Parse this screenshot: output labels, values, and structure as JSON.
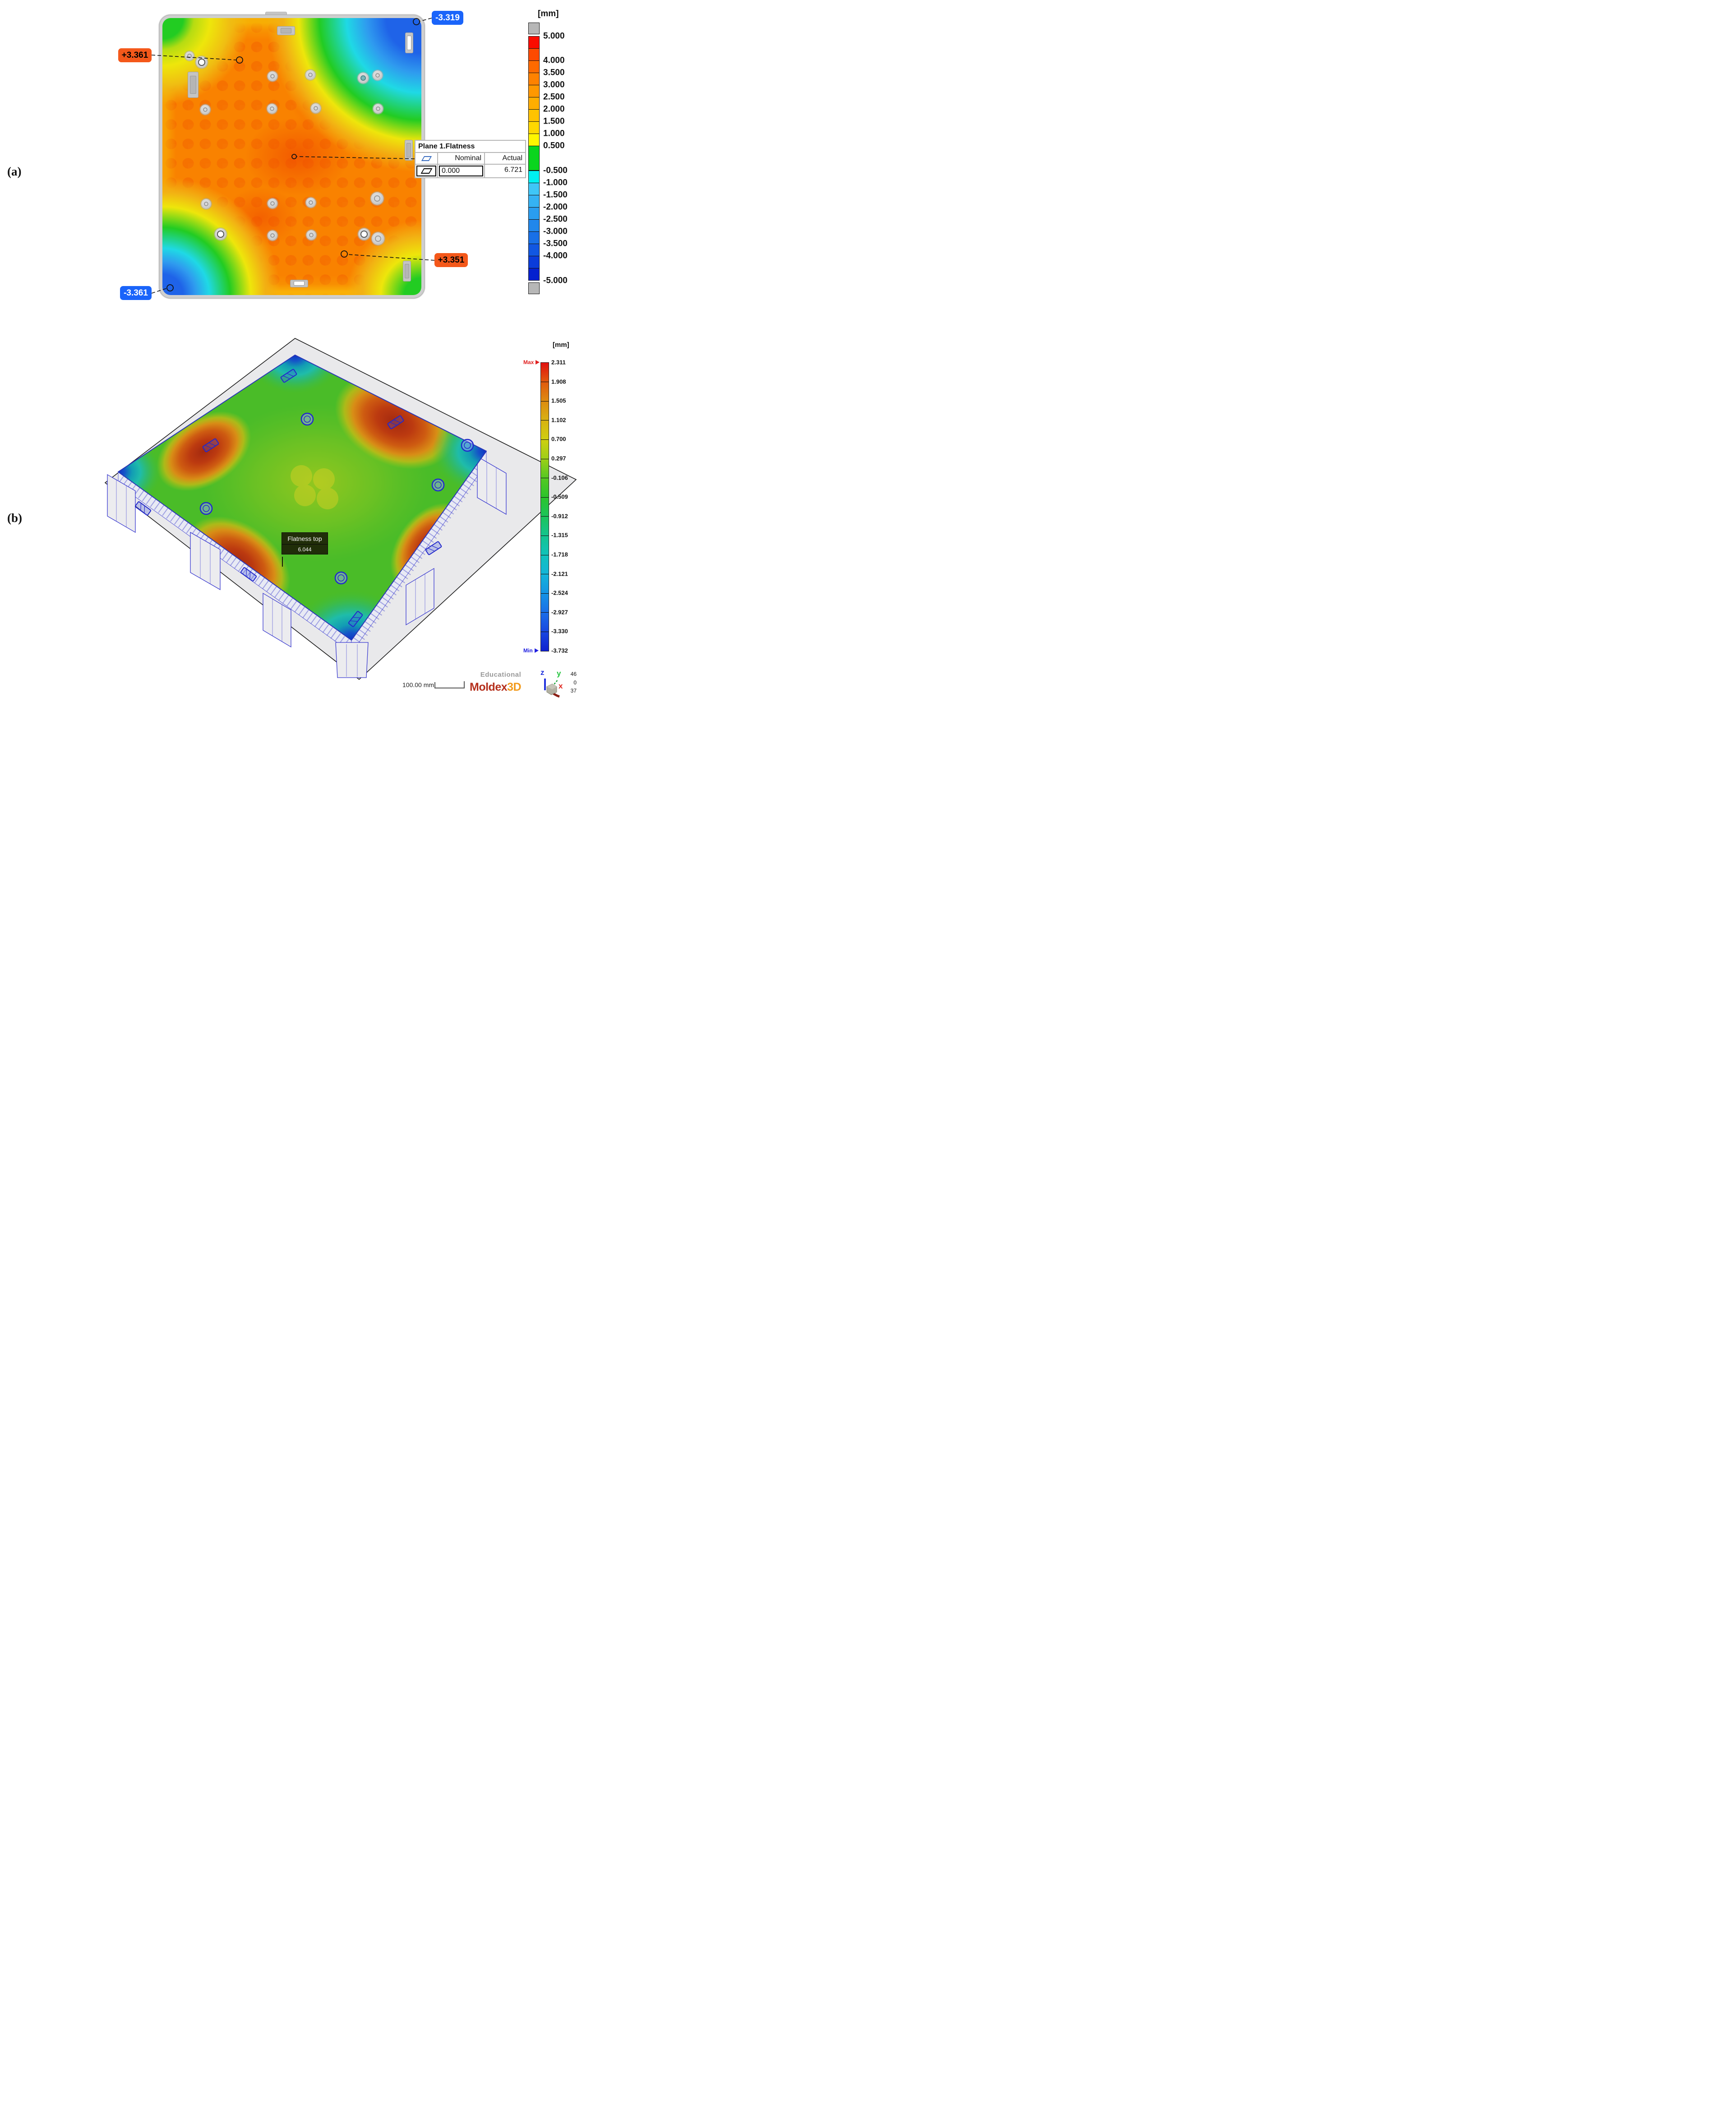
{
  "figure": {
    "panel_a_label": "(a)",
    "panel_b_label": "(b)"
  },
  "panel_a": {
    "unit_label": "[mm]",
    "badges": {
      "max_top": "+3.361",
      "min_top": "-3.319",
      "min_bottom": "-3.361",
      "max_bottom": "+3.351"
    },
    "badge_colors": {
      "positive": "#f4581a",
      "negative": "#1a64fa"
    },
    "table": {
      "title": "Plane 1.Flatness",
      "nominal_header": "Nominal",
      "actual_header": "Actual",
      "nominal_value": "0.000",
      "actual_value": "6.721"
    },
    "legend": {
      "bottom_label": "-5.000",
      "boxes": [
        {
          "c": "#b7b7b7",
          "u": 1,
          "t": "",
          "gray": true
        },
        {
          "c": "#fb0c00",
          "u": 1,
          "t": "5.000"
        },
        {
          "c": "#fd4a00",
          "u": 1,
          "t": ""
        },
        {
          "c": "#fe6a00",
          "u": 1,
          "t": "4.000"
        },
        {
          "c": "#fe8200",
          "u": 1,
          "t": "3.500"
        },
        {
          "c": "#ff9800",
          "u": 1,
          "t": "3.000"
        },
        {
          "c": "#ffae00",
          "u": 1,
          "t": "2.500"
        },
        {
          "c": "#ffc300",
          "u": 1,
          "t": "2.000"
        },
        {
          "c": "#ffd800",
          "u": 1,
          "t": "1.500"
        },
        {
          "c": "#fff600",
          "u": 1,
          "t": "1.000"
        },
        {
          "c": "#0ad51e",
          "u": 2,
          "t": "0.500"
        },
        {
          "c": "#00f0f0",
          "u": 1,
          "t": "-0.500"
        },
        {
          "c": "#3fc6f7",
          "u": 1,
          "t": "-1.000"
        },
        {
          "c": "#35b2f3",
          "u": 1,
          "t": "-1.500"
        },
        {
          "c": "#2a9def",
          "u": 1,
          "t": "-2.000"
        },
        {
          "c": "#2187eb",
          "u": 1,
          "t": "-2.500"
        },
        {
          "c": "#1970e7",
          "u": 1,
          "t": "-3.000"
        },
        {
          "c": "#1157e2",
          "u": 1,
          "t": "-3.500"
        },
        {
          "c": "#0a3cda",
          "u": 1,
          "t": "-4.000"
        },
        {
          "c": "#0420cf",
          "u": 1,
          "t": ""
        },
        {
          "c": "#b7b7b7",
          "u": 1,
          "t": "",
          "gray": true
        }
      ]
    }
  },
  "panel_b": {
    "unit_label": "[mm]",
    "max_label": "Max",
    "min_label": "Min",
    "legend": {
      "tick_labels": [
        "2.311",
        "1.908",
        "1.505",
        "1.102",
        "0.700",
        "0.297",
        "-0.106",
        "-0.509",
        "-0.912",
        "-1.315",
        "-1.718",
        "-2.121",
        "-2.524",
        "-2.927",
        "-3.330",
        "-3.732"
      ],
      "colors": [
        "#e01010",
        "#e05a0e",
        "#dd8b10",
        "#d8b212",
        "#cfcf12",
        "#9dcf17",
        "#55c822",
        "#2cc42c",
        "#1bc45a",
        "#14c48f",
        "#12c2bb",
        "#14b4d8",
        "#1694e4",
        "#1a6ee8",
        "#1847e0",
        "#1021cf"
      ]
    },
    "tooltip": {
      "title": "Flatness top",
      "value": "6.044"
    },
    "scale_bar_label": "100.00 mm",
    "watermark": "Educational",
    "brand": {
      "name": "Moldex",
      "suffix": "3D",
      "name_color": "#b5301d",
      "suffix_color": "#f29a1b"
    },
    "axes": {
      "x": "x",
      "y": "y",
      "z": "z"
    },
    "view_numbers": [
      "46",
      "0",
      "37"
    ]
  },
  "chart_data": [
    {
      "type": "heatmap",
      "panel": "a",
      "title": "Measured surface flatness deviation map (pallet top view)",
      "unit": "mm",
      "colorbar_range": [
        -5.0,
        5.0
      ],
      "colorbar_ticks": [
        5.0,
        4.0,
        3.5,
        3.0,
        2.5,
        2.0,
        1.5,
        1.0,
        0.5,
        -0.5,
        -1.0,
        -1.5,
        -2.0,
        -2.5,
        -3.0,
        -3.5,
        -4.0,
        -5.0
      ],
      "annotations": [
        {
          "label": "+3.361",
          "value": 3.361,
          "location": "upper center of pallet"
        },
        {
          "label": "-3.319",
          "value": -3.319,
          "location": "top-right corner"
        },
        {
          "label": "-3.361",
          "value": -3.361,
          "location": "bottom-left corner"
        },
        {
          "label": "+3.351",
          "value": 3.351,
          "location": "lower center-right"
        }
      ],
      "flatness": {
        "feature": "Plane 1.Flatness",
        "nominal": 0.0,
        "actual": 6.721
      },
      "pattern": "warm orange (+3 mm) dome in center, cool blue (-3 mm) zones at top-right and bottom-left corners"
    },
    {
      "type": "heatmap",
      "panel": "b",
      "title": "Moldex3D simulated flatness, top surface (isometric view)",
      "unit": "mm",
      "max": 2.311,
      "min": -3.732,
      "colorbar_range": [
        -3.732,
        2.311
      ],
      "colorbar_ticks": [
        2.311,
        1.908,
        1.505,
        1.102,
        0.7,
        0.297,
        -0.106,
        -0.509,
        -0.912,
        -1.315,
        -1.718,
        -2.121,
        -2.524,
        -2.927,
        -3.33,
        -3.732
      ],
      "flatness_top": 6.044,
      "scale_bar_mm": 100.0,
      "view_numbers": [
        46,
        0,
        37
      ],
      "pattern": "green base with red warp peaks at four quadrant edges and blue sunken corners"
    }
  ]
}
